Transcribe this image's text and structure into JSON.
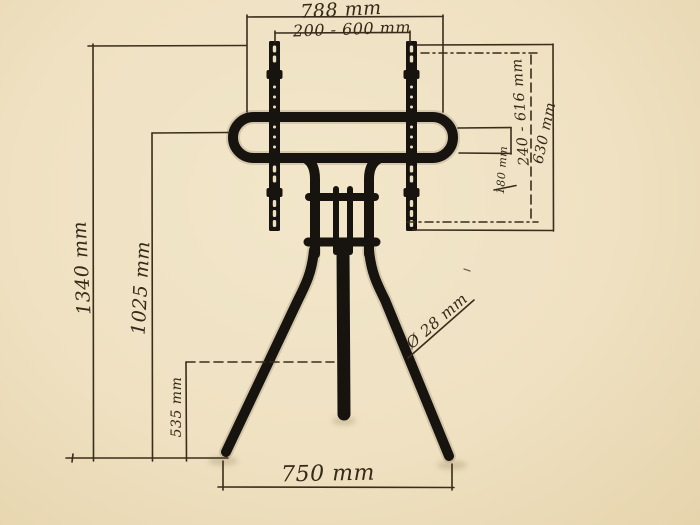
{
  "dimensions": {
    "top_width": "788 mm",
    "vesa_width_range": "200 - 600 mm",
    "vesa_height_range": "240 - 616 mm",
    "bracket_height": "630 mm",
    "tube_center_offset": "180 mm",
    "total_height": "1340 mm",
    "mount_height": "1025 mm",
    "lower_section_height": "535 mm",
    "base_width": "750 mm",
    "tube_diameter": "Ø 28 mm"
  },
  "colors": {
    "paper": "#f0e2c4",
    "ink": "#3a2d1b",
    "stand": "#17130e"
  }
}
